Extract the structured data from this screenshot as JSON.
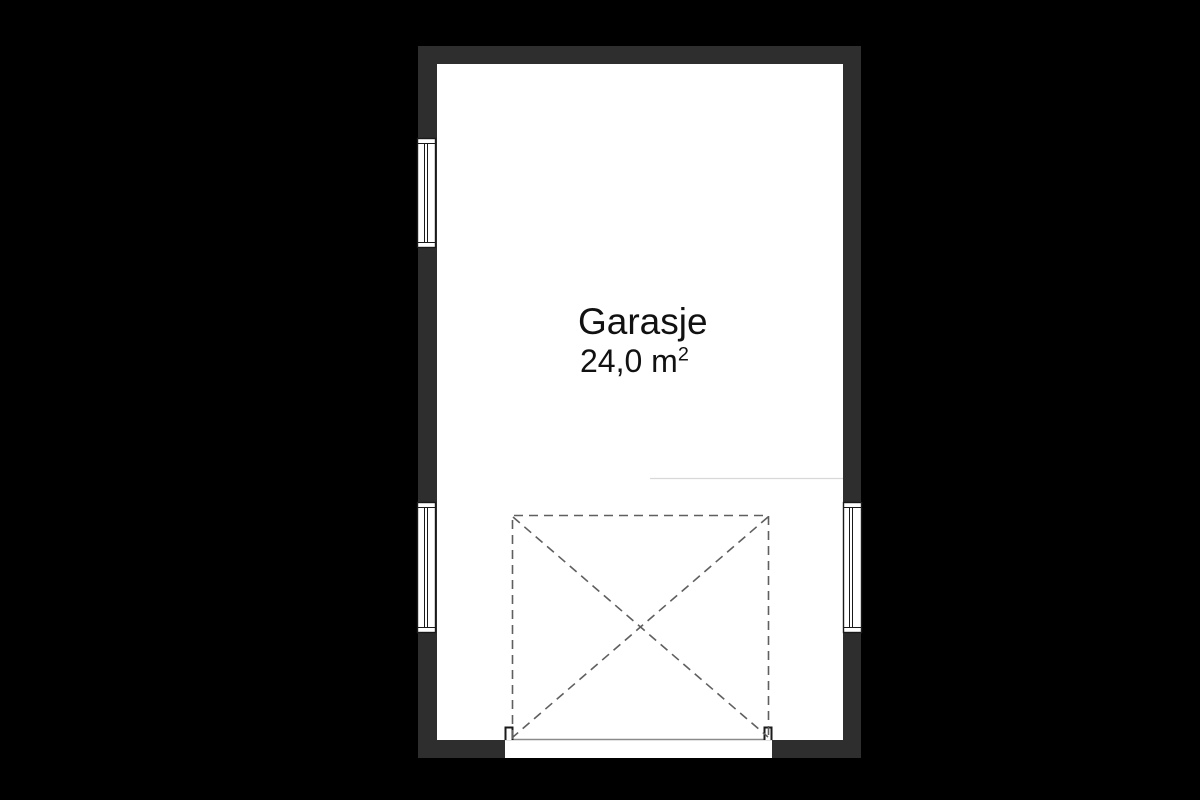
{
  "floorplan": {
    "room": {
      "name": "Garasje",
      "area_label": "24,0 m²",
      "area_value": "24,0 m",
      "area_superscript": "2"
    },
    "colors": {
      "background": "#000000",
      "wall": "#2e2e2e",
      "floor": "#ffffff",
      "outline": "#1a1a1a",
      "dashed_line": "#5f5f5f",
      "door_line": "#8a8a8a",
      "faint_line": "#d8d8d8"
    }
  }
}
